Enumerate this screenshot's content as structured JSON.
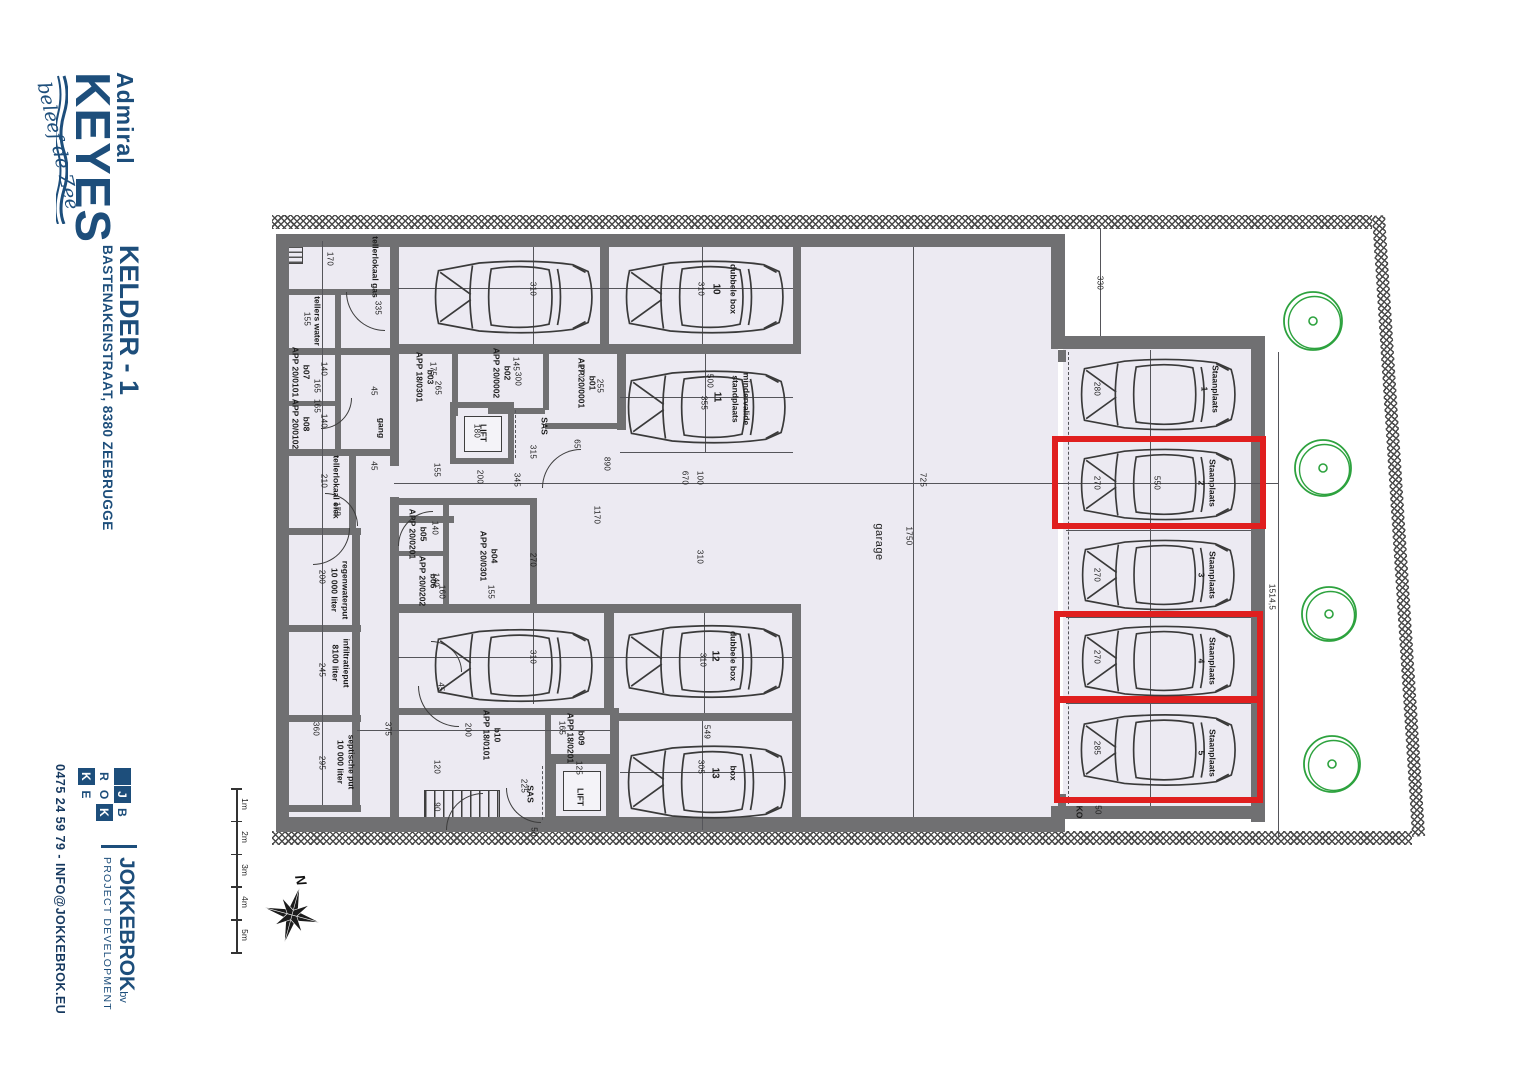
{
  "colors": {
    "brand_blue": "#1d4e7b",
    "wall_gray": "#707072",
    "floor": "#eceaf2",
    "highlight_red": "#e01f1f",
    "tree_green": "#2da23e"
  },
  "branding": {
    "logo": {
      "line1": "Admiral",
      "line2": "KEYES",
      "tagline": "beleef de Zee"
    },
    "sheet_title": "KELDER - 1",
    "sheet_address": "BASTENAKENSTRAAT, 8380 ZEEBRUGGE",
    "developer": {
      "name": "JOKKEBROK",
      "suffix": "bv",
      "subtitle": "PROJECT DEVELOPMENT",
      "contact": "0475 24 59 79 - INFO@JOKKEBROK.EU",
      "logo_cells": [
        {
          "ch": "",
          "fill": true
        },
        {
          "ch": "J",
          "fill": true
        },
        {
          "ch": "B",
          "fill": false
        },
        {
          "ch": "R",
          "fill": false
        },
        {
          "ch": "O",
          "fill": false
        },
        {
          "ch": "K",
          "fill": true
        },
        {
          "ch": "K",
          "fill": true
        },
        {
          "ch": "E",
          "fill": false
        },
        {
          "ch": "",
          "fill": false
        }
      ]
    }
  },
  "scale_bar": {
    "labels": [
      "1m",
      "2m",
      "3m",
      "4m",
      "5m"
    ]
  },
  "compass": {
    "label": "N"
  },
  "plan": {
    "garage_label": "garage",
    "walls": [
      [
        276,
        234,
        789,
        13
      ],
      [
        276,
        817,
        789,
        15
      ],
      [
        276,
        234,
        13,
        598
      ],
      [
        1051,
        234,
        14,
        110
      ],
      [
        1051,
        336,
        213,
        13
      ],
      [
        1251,
        336,
        14,
        486
      ],
      [
        1051,
        806,
        213,
        13
      ],
      [
        283,
        289,
        110,
        6
      ],
      [
        276,
        348,
        118,
        7
      ],
      [
        283,
        401,
        56,
        5
      ],
      [
        276,
        449,
        119,
        7
      ],
      [
        276,
        528,
        85,
        7
      ],
      [
        276,
        625,
        85,
        7
      ],
      [
        276,
        715,
        85,
        7
      ],
      [
        276,
        805,
        85,
        7
      ],
      [
        335,
        289,
        6,
        64
      ],
      [
        335,
        353,
        6,
        99
      ],
      [
        349,
        449,
        7,
        84
      ],
      [
        352,
        528,
        8,
        282
      ],
      [
        390,
        234,
        9,
        232
      ],
      [
        390,
        497,
        9,
        215
      ],
      [
        390,
        711,
        9,
        121
      ],
      [
        396,
        344,
        400,
        10
      ],
      [
        600,
        234,
        9,
        112
      ],
      [
        793,
        234,
        8,
        120
      ],
      [
        617,
        346,
        9,
        84
      ],
      [
        452,
        354,
        6,
        62
      ],
      [
        543,
        354,
        6,
        56
      ],
      [
        545,
        423,
        76,
        6
      ],
      [
        488,
        408,
        57,
        6
      ],
      [
        396,
        516,
        58,
        7
      ],
      [
        396,
        498,
        141,
        7
      ],
      [
        396,
        604,
        141,
        7
      ],
      [
        530,
        498,
        7,
        112
      ],
      [
        443,
        498,
        6,
        110
      ],
      [
        398,
        551,
        45,
        5
      ],
      [
        390,
        708,
        229,
        7
      ],
      [
        610,
        708,
        9,
        124
      ],
      [
        545,
        712,
        6,
        118
      ],
      [
        545,
        754,
        74,
        6
      ],
      [
        394,
        604,
        407,
        9
      ],
      [
        604,
        613,
        10,
        98
      ],
      [
        618,
        713,
        176,
        8
      ],
      [
        792,
        613,
        9,
        217
      ],
      [
        1058,
        350,
        8,
        12
      ],
      [
        1058,
        794,
        8,
        12
      ]
    ],
    "lines": [
      [
        398,
        288,
        793,
        288
      ],
      [
        620,
        397,
        793,
        397
      ],
      [
        620,
        452,
        793,
        452
      ],
      [
        398,
        657,
        792,
        657
      ],
      [
        620,
        772,
        792,
        772
      ],
      [
        394,
        483,
        1278,
        483
      ],
      [
        913,
        247,
        913,
        817
      ],
      [
        1100,
        228,
        1100,
        336
      ],
      [
        1278,
        352,
        1278,
        838
      ],
      [
        1150,
        350,
        1150,
        806
      ],
      [
        322,
        241,
        322,
        805
      ],
      [
        533,
        247,
        533,
        344
      ],
      [
        702,
        247,
        702,
        344
      ],
      [
        705,
        354,
        705,
        452
      ],
      [
        533,
        613,
        533,
        704
      ],
      [
        704,
        613,
        704,
        713
      ],
      [
        702,
        721,
        702,
        830
      ],
      [
        357,
        730,
        610,
        730
      ],
      [
        1066,
        440,
        1251,
        440
      ],
      [
        1066,
        530,
        1251,
        530
      ],
      [
        1066,
        617,
        1251,
        617
      ],
      [
        1066,
        703,
        1251,
        703
      ]
    ],
    "dashed": [
      [
        1068,
        352,
        1068,
        804
      ],
      [
        515,
        410,
        515,
        458
      ],
      [
        542,
        766,
        542,
        820
      ]
    ],
    "doors": [
      {
        "x": 346,
        "y": 292,
        "r": 38,
        "rot": 0
      },
      {
        "x": 352,
        "y": 398,
        "r": 30,
        "rot": 270
      },
      {
        "x": 358,
        "y": 460,
        "r": 32,
        "rot": 180
      },
      {
        "x": 398,
        "y": 476,
        "r": 34,
        "rot": 90
      },
      {
        "x": 542,
        "y": 410,
        "r": 38,
        "rot": 90
      },
      {
        "x": 350,
        "y": 528,
        "r": 36,
        "rot": 270
      },
      {
        "x": 418,
        "y": 686,
        "r": 40,
        "rot": 0
      },
      {
        "x": 446,
        "y": 756,
        "r": 36,
        "rot": 90
      },
      {
        "x": 506,
        "y": 788,
        "r": 34,
        "rot": 0
      },
      {
        "x": 462,
        "y": 610,
        "r": 30,
        "rot": 180
      }
    ],
    "highlight_boxes": [
      {
        "space": "Staanplaats 2",
        "x": 1052,
        "y": 436,
        "w": 214,
        "h": 93
      },
      {
        "space": "Staanplaats 4",
        "x": 1054,
        "y": 611,
        "w": 209,
        "h": 92
      },
      {
        "space": "Staanplaats 5",
        "x": 1054,
        "y": 696,
        "w": 209,
        "h": 107
      }
    ],
    "trees": [
      {
        "x": 1313,
        "y": 321,
        "r": 29
      },
      {
        "x": 1323,
        "y": 468,
        "r": 28
      },
      {
        "x": 1329,
        "y": 614,
        "r": 27
      },
      {
        "x": 1332,
        "y": 764,
        "r": 28
      }
    ],
    "cars": [
      {
        "x": 430,
        "y": 253,
        "w": 170,
        "h": 88
      },
      {
        "x": 621,
        "y": 253,
        "w": 170,
        "h": 88
      },
      {
        "x": 623,
        "y": 363,
        "w": 170,
        "h": 88
      },
      {
        "x": 430,
        "y": 622,
        "w": 170,
        "h": 87
      },
      {
        "x": 621,
        "y": 618,
        "w": 170,
        "h": 87
      },
      {
        "x": 623,
        "y": 739,
        "w": 170,
        "h": 86
      },
      {
        "x": 1076,
        "y": 357,
        "w": 167,
        "h": 75
      },
      {
        "x": 1076,
        "y": 447,
        "w": 167,
        "h": 75
      },
      {
        "x": 1076,
        "y": 538,
        "w": 167,
        "h": 74
      },
      {
        "x": 1076,
        "y": 624,
        "w": 167,
        "h": 74
      },
      {
        "x": 1076,
        "y": 712,
        "w": 167,
        "h": 76
      }
    ],
    "labels": [
      {
        "text": "tellerlokaal gas",
        "x": 375,
        "y": 267
      },
      {
        "text": "tellers water",
        "x": 317,
        "y": 321
      },
      {
        "text": "b07\nAPP 20/0101",
        "x": 301,
        "y": 372
      },
      {
        "text": "b08\nAPP 20/0102",
        "x": 301,
        "y": 424
      },
      {
        "text": "tellerlokaal elek",
        "x": 336,
        "y": 487
      },
      {
        "text": "gang",
        "x": 381,
        "y": 428
      },
      {
        "text": "b03\nAPP 18/0301",
        "x": 425,
        "y": 377
      },
      {
        "text": "b02\nAPP 20/0002",
        "x": 502,
        "y": 373
      },
      {
        "text": "b01\nAPP 20/0001",
        "x": 587,
        "y": 383
      },
      {
        "text": "LIFT",
        "x": 483,
        "y": 433
      },
      {
        "text": "SAS",
        "x": 544,
        "y": 426
      },
      {
        "text": "b05\nAPP 20/0201",
        "x": 418,
        "y": 534
      },
      {
        "text": "b06\nAPP 20/0202",
        "x": 428,
        "y": 581
      },
      {
        "text": "b04\nAPP 20/0301",
        "x": 489,
        "y": 556
      },
      {
        "text": "regenwaterput\n10 000 liter",
        "x": 340,
        "y": 590
      },
      {
        "text": "infiltratieput\n8100 liter",
        "x": 341,
        "y": 663
      },
      {
        "text": "septische put\n10 000 liter",
        "x": 346,
        "y": 762
      },
      {
        "text": "b10\nAPP 18/0101",
        "x": 492,
        "y": 735
      },
      {
        "text": "b09\nAPP 18/0201",
        "x": 576,
        "y": 738
      },
      {
        "text": "LIFT",
        "x": 580,
        "y": 797
      },
      {
        "text": "SAS",
        "x": 530,
        "y": 794
      },
      {
        "text": "garage",
        "x": 878,
        "y": 542,
        "s": "big"
      },
      {
        "text": "dubbele box",
        "x": 733,
        "y": 289
      },
      {
        "text": "10",
        "x": 715,
        "y": 289,
        "s": "num"
      },
      {
        "text": "mindervalide\nstandplaats",
        "x": 741,
        "y": 399
      },
      {
        "text": "11",
        "x": 716,
        "y": 397,
        "s": "num"
      },
      {
        "text": "dubbele box",
        "x": 733,
        "y": 656
      },
      {
        "text": "12",
        "x": 714,
        "y": 656,
        "s": "num"
      },
      {
        "text": "box",
        "x": 733,
        "y": 773
      },
      {
        "text": "13",
        "x": 714,
        "y": 773,
        "s": "num"
      },
      {
        "text": "Staanplaats\n1",
        "x": 1210,
        "y": 389,
        "s": "sp"
      },
      {
        "text": "Staanplaats\n2",
        "x": 1207,
        "y": 483,
        "s": "sp"
      },
      {
        "text": "Staanplaats\n3",
        "x": 1207,
        "y": 575,
        "s": "sp"
      },
      {
        "text": "Staanplaats\n4",
        "x": 1207,
        "y": 661,
        "s": "sp"
      },
      {
        "text": "Staanplaats\n5",
        "x": 1207,
        "y": 753,
        "s": "sp"
      },
      {
        "text": "KO",
        "x": 1079,
        "y": 812
      }
    ],
    "dimensions": [
      {
        "t": "170",
        "x": 330,
        "y": 259
      },
      {
        "t": "335",
        "x": 378,
        "y": 308
      },
      {
        "t": "155",
        "x": 307,
        "y": 319
      },
      {
        "t": "140",
        "x": 324,
        "y": 369
      },
      {
        "t": "165",
        "x": 317,
        "y": 386
      },
      {
        "t": "140",
        "x": 324,
        "y": 421
      },
      {
        "t": "165",
        "x": 317,
        "y": 406
      },
      {
        "t": "210",
        "x": 324,
        "y": 481
      },
      {
        "t": "175",
        "x": 337,
        "y": 509
      },
      {
        "t": "45",
        "x": 374,
        "y": 391
      },
      {
        "t": "45",
        "x": 374,
        "y": 466
      },
      {
        "t": "45",
        "x": 441,
        "y": 687
      },
      {
        "t": "175",
        "x": 433,
        "y": 369
      },
      {
        "t": "265",
        "x": 438,
        "y": 388
      },
      {
        "t": "145",
        "x": 516,
        "y": 364
      },
      {
        "t": "300",
        "x": 518,
        "y": 379
      },
      {
        "t": "170",
        "x": 581,
        "y": 371
      },
      {
        "t": "255",
        "x": 600,
        "y": 386
      },
      {
        "t": "180",
        "x": 477,
        "y": 431
      },
      {
        "t": "200",
        "x": 480,
        "y": 477
      },
      {
        "t": "65",
        "x": 577,
        "y": 444
      },
      {
        "t": "315",
        "x": 533,
        "y": 452
      },
      {
        "t": "345",
        "x": 517,
        "y": 480
      },
      {
        "t": "155",
        "x": 437,
        "y": 470
      },
      {
        "t": "890",
        "x": 607,
        "y": 464
      },
      {
        "t": "1170",
        "x": 597,
        "y": 515
      },
      {
        "t": "140",
        "x": 435,
        "y": 528
      },
      {
        "t": "140",
        "x": 436,
        "y": 580
      },
      {
        "t": "160",
        "x": 442,
        "y": 592
      },
      {
        "t": "155",
        "x": 491,
        "y": 592
      },
      {
        "t": "270",
        "x": 533,
        "y": 560
      },
      {
        "t": "200",
        "x": 322,
        "y": 577
      },
      {
        "t": "245",
        "x": 322,
        "y": 670
      },
      {
        "t": "360",
        "x": 316,
        "y": 729
      },
      {
        "t": "295",
        "x": 322,
        "y": 763
      },
      {
        "t": "375",
        "x": 388,
        "y": 729
      },
      {
        "t": "200",
        "x": 468,
        "y": 730
      },
      {
        "t": "165",
        "x": 562,
        "y": 728
      },
      {
        "t": "125",
        "x": 579,
        "y": 768
      },
      {
        "t": "225",
        "x": 524,
        "y": 786
      },
      {
        "t": "120",
        "x": 437,
        "y": 767
      },
      {
        "t": "90",
        "x": 437,
        "y": 807
      },
      {
        "t": "50",
        "x": 534,
        "y": 832
      },
      {
        "t": "310",
        "x": 533,
        "y": 289
      },
      {
        "t": "310",
        "x": 701,
        "y": 289
      },
      {
        "t": "500",
        "x": 710,
        "y": 381
      },
      {
        "t": "355",
        "x": 704,
        "y": 403
      },
      {
        "t": "310",
        "x": 533,
        "y": 657
      },
      {
        "t": "310",
        "x": 703,
        "y": 660
      },
      {
        "t": "549",
        "x": 707,
        "y": 732
      },
      {
        "t": "305",
        "x": 701,
        "y": 767
      },
      {
        "t": "670",
        "x": 685,
        "y": 478
      },
      {
        "t": "100",
        "x": 700,
        "y": 478
      },
      {
        "t": "310",
        "x": 700,
        "y": 557
      },
      {
        "t": "725",
        "x": 923,
        "y": 480
      },
      {
        "t": "1750",
        "x": 909,
        "y": 536
      },
      {
        "t": "330",
        "x": 1100,
        "y": 283
      },
      {
        "t": "280",
        "x": 1097,
        "y": 389
      },
      {
        "t": "270",
        "x": 1097,
        "y": 483
      },
      {
        "t": "550",
        "x": 1157,
        "y": 483
      },
      {
        "t": "270",
        "x": 1097,
        "y": 575
      },
      {
        "t": "270",
        "x": 1097,
        "y": 657
      },
      {
        "t": "285",
        "x": 1097,
        "y": 748
      },
      {
        "t": "50",
        "x": 1098,
        "y": 810
      },
      {
        "t": "1514,5",
        "x": 1272,
        "y": 597
      }
    ]
  }
}
